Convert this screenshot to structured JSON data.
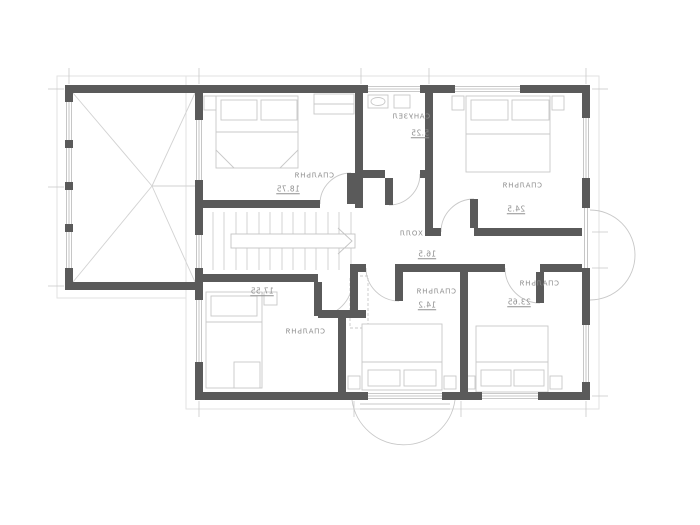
{
  "drawing": {
    "type": "architectural floor plan, second storey",
    "text_mirrored_in_image": true
  },
  "rooms": [
    {
      "id": "bedroom-top-left",
      "name": "СПАЛЬНЯ",
      "area": "18.75"
    },
    {
      "id": "bathroom-top-middle",
      "name": "САНУЗЕЛ",
      "area": "5.25"
    },
    {
      "id": "bedroom-top-right",
      "name": "СПАЛЬНЯ",
      "area": "24.5"
    },
    {
      "id": "hall-center",
      "name": "ХОЛЛ",
      "area": "16.5"
    },
    {
      "id": "bedroom-bottom-left",
      "name": "СПАЛЬНЯ",
      "area": "17.55"
    },
    {
      "id": "bedroom-bottom-middle",
      "name": "СПАЛЬНЯ",
      "area": "14.2"
    },
    {
      "id": "bedroom-bottom-right",
      "name": "СПАЛЬНЯ",
      "area": "23.65"
    }
  ],
  "colors": {
    "background": "#ffffff",
    "wall": "#5a5a5a",
    "furniture_line": "#c8c8c8",
    "window_line": "#b8b8b8",
    "eaves_line": "#e2e2e2",
    "text": "#8f8f8f"
  }
}
